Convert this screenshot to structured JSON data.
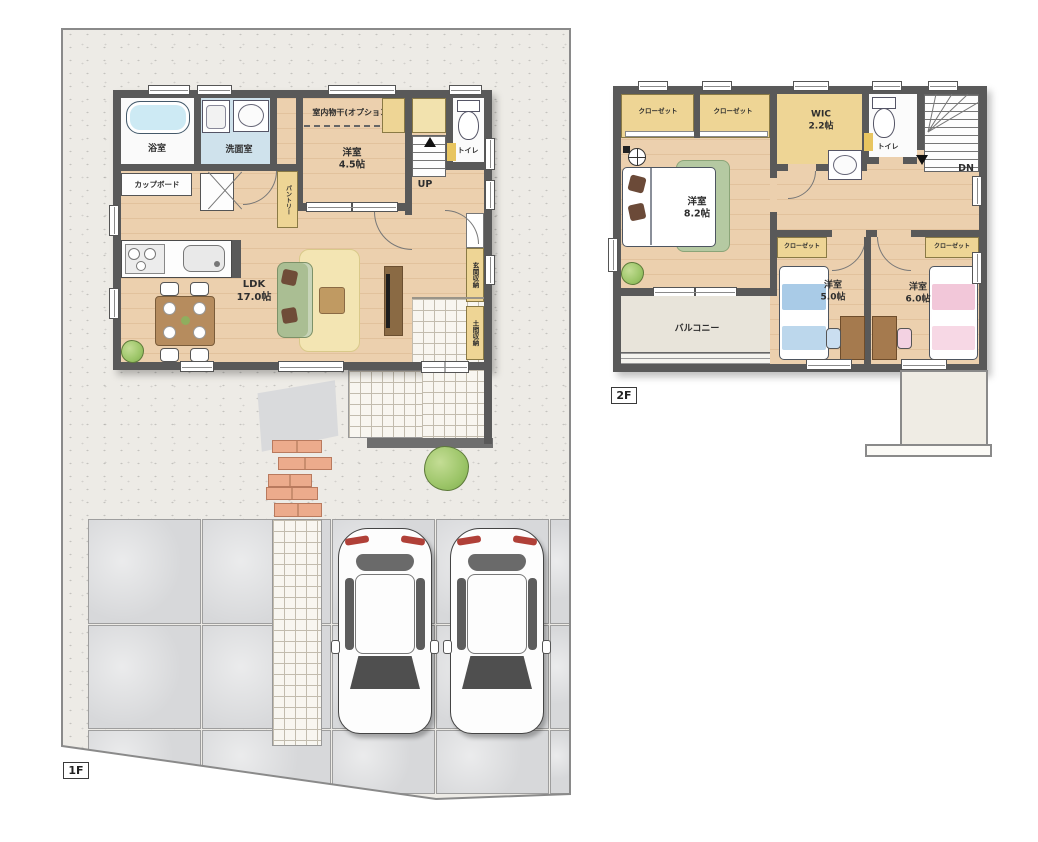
{
  "floor1": {
    "tag": "1F",
    "labels": {
      "bath": "浴室",
      "washroom": "洗面室",
      "cupboard": "カップボード",
      "indoor_drying": "室内物干(オプション)",
      "pantry": "パントリー",
      "bedroom_name": "洋室",
      "bedroom_size": "4.5帖",
      "toilet": "トイレ",
      "stairs_up": "UP",
      "ldk_name": "LDK",
      "ldk_size": "17.0帖",
      "entrance_storage": "玄関収納",
      "doma_storage": "土間収納"
    }
  },
  "floor2": {
    "tag": "2F",
    "labels": {
      "closet": "クローゼット",
      "wic_name": "WIC",
      "wic_size": "2.2帖",
      "toilet": "トイレ",
      "stairs_down": "DN",
      "bedroom82_name": "洋室",
      "bedroom82_size": "8.2帖",
      "bedroom50_name": "洋室",
      "bedroom50_size": "5.0帖",
      "bedroom60_name": "洋室",
      "bedroom60_size": "6.0帖",
      "balcony": "バルコニー"
    }
  },
  "colors": {
    "wall": "#595959",
    "wood_floor": "#ecd0ae",
    "washroom_floor": "#cfe2ec",
    "closet_yellow": "#eed595",
    "bathtub": "#cdeaf4",
    "rug": "#f3e5b3",
    "sofa_green": "#aabe93",
    "bed_blue": "#a9cbe7",
    "bed_pink": "#f2c7d9",
    "balcony_floor": "#e8e4da",
    "ground": "#edebe6",
    "slab": "#d7d8da",
    "brick": "#ecab8c",
    "bush_green": "#9cc568",
    "tail_light": "#b04038"
  }
}
